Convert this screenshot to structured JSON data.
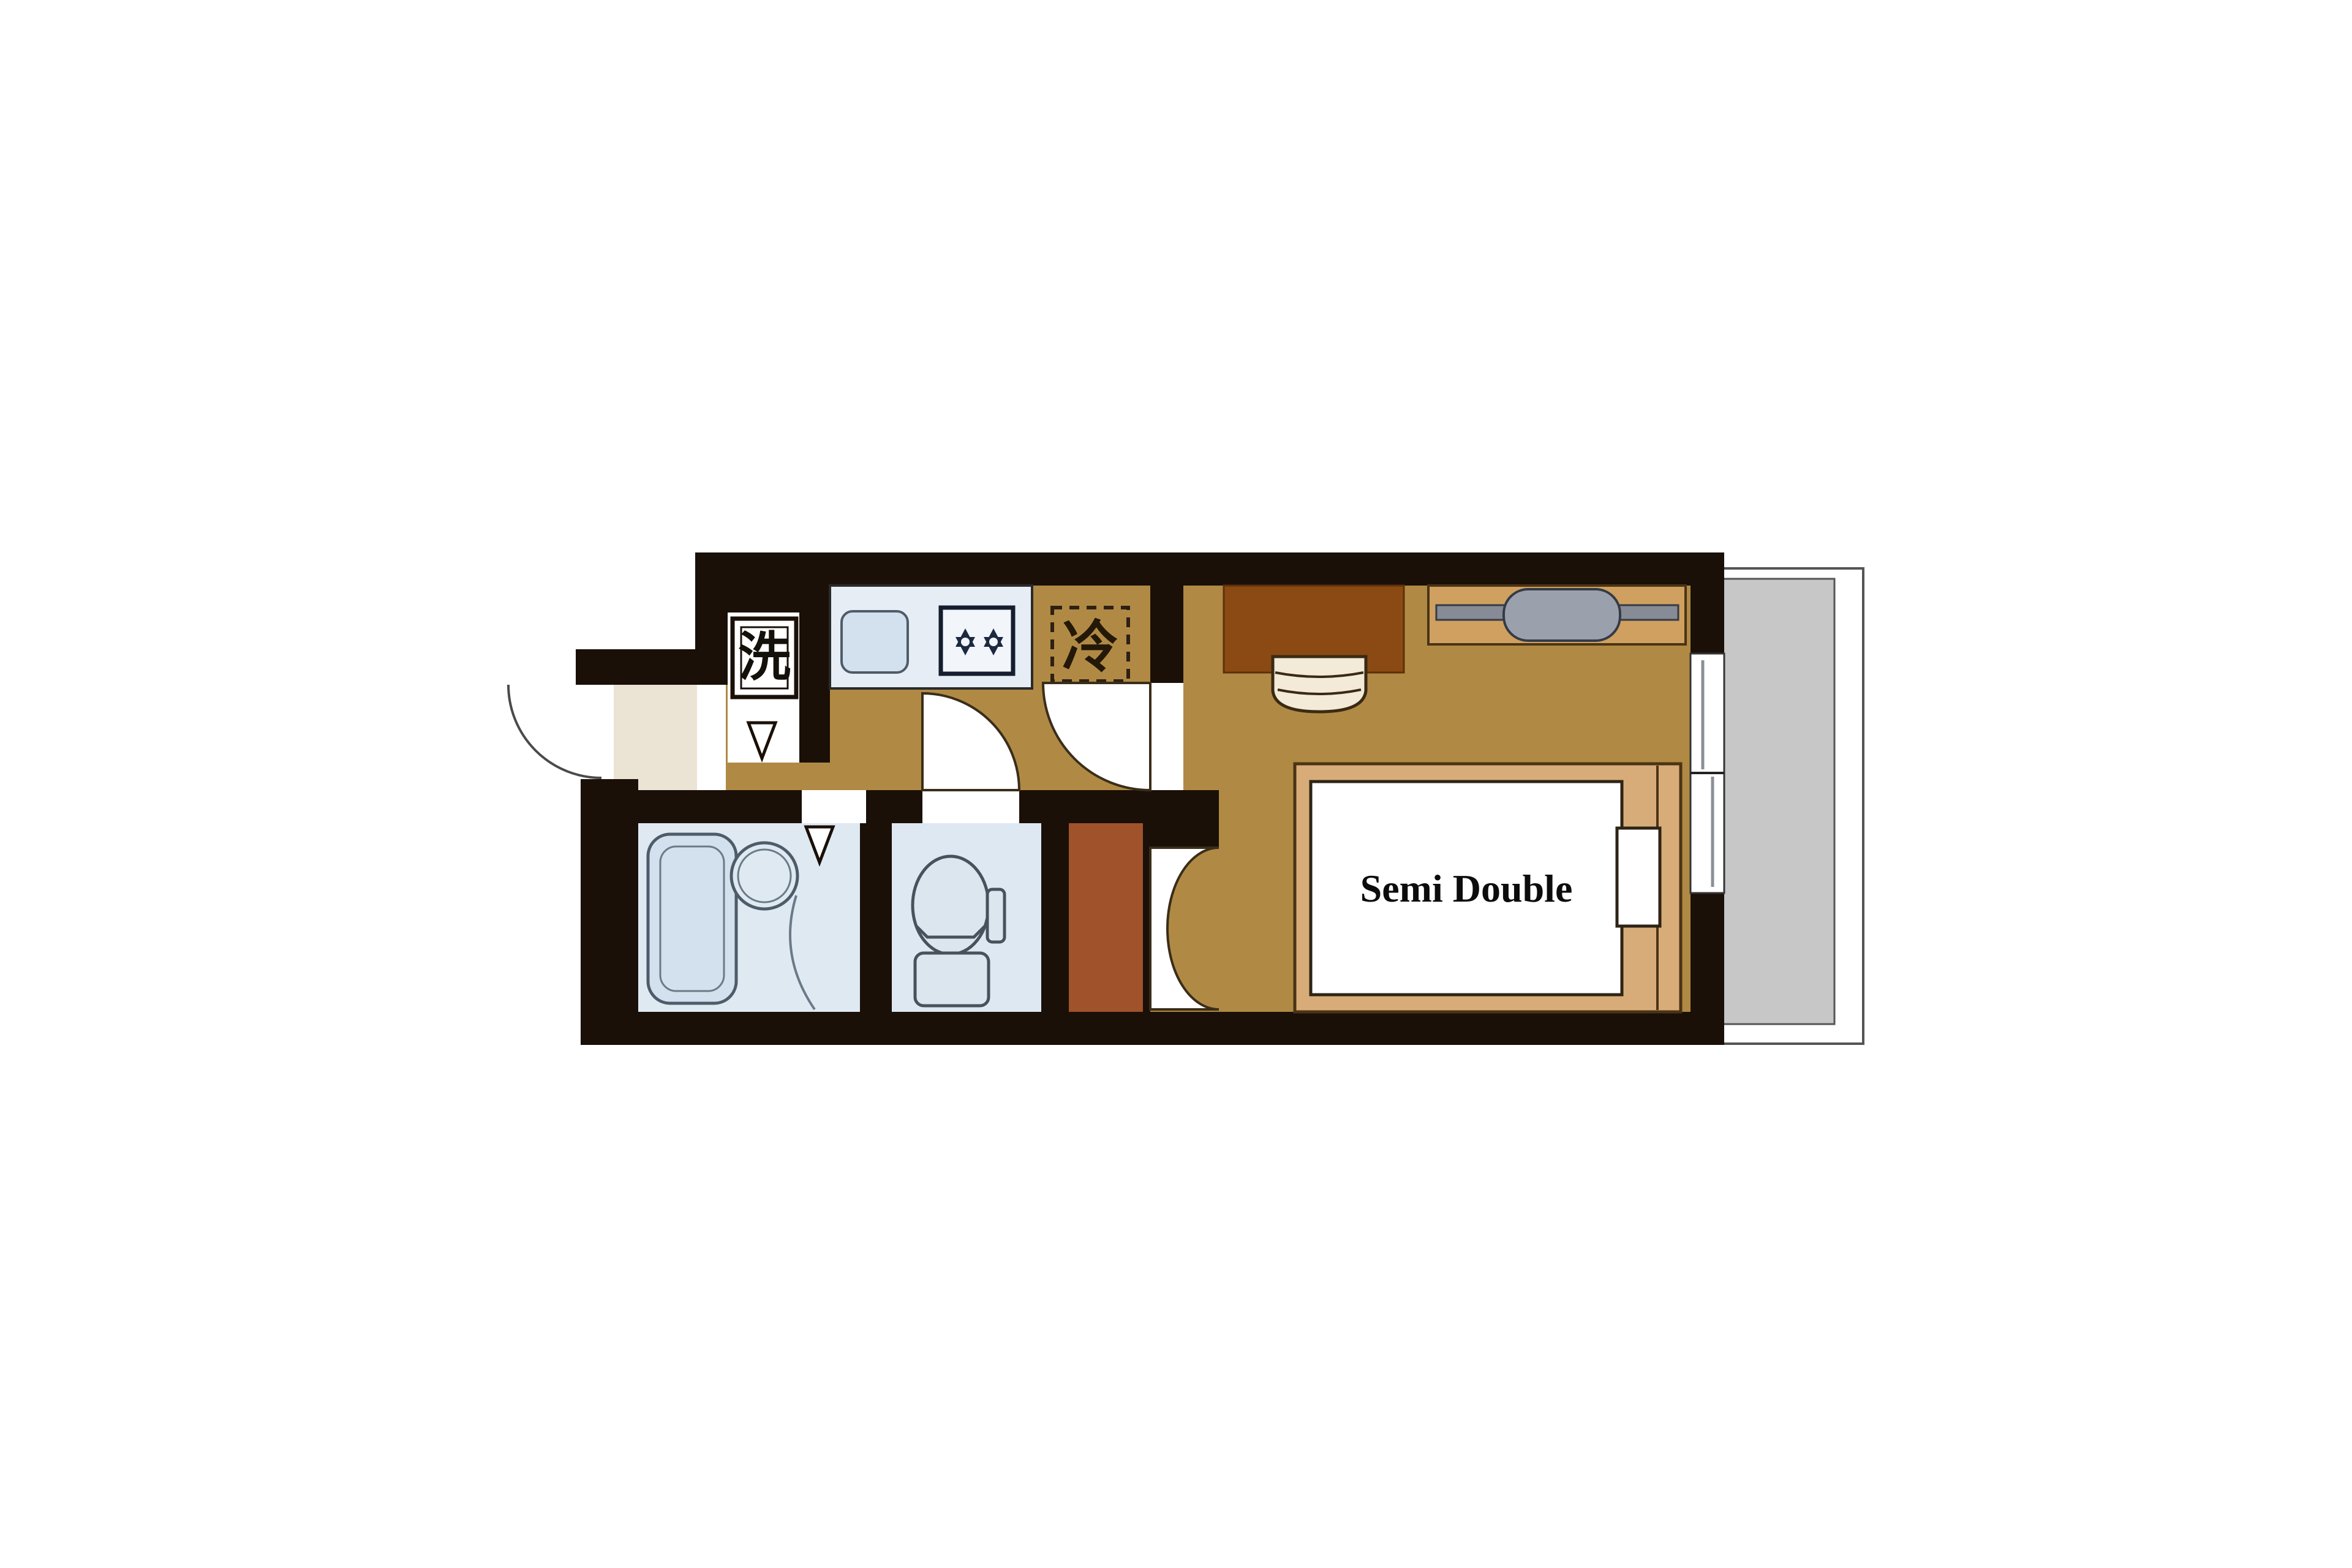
{
  "plan": {
    "labels": {
      "washer": "洗",
      "fridge": "冷",
      "bed_size": "Semi Double"
    },
    "palette": {
      "wall": "#1a1008",
      "floor_tan": "#b08a44",
      "desk_brown": "#8b4a13",
      "closet_sienna": "#a0522a",
      "bed_frame": "#d8ac79",
      "fixture_blue": "#d3e0ed",
      "fixture_border": "#4e5c6a",
      "bath_floor": "#dfe9f2",
      "counter_field": "#e7edf4",
      "balcony_gray": "#c7c7c7",
      "genkan_cream": "#ebe3d3",
      "hanger_frame": "#cfa05f",
      "hanger_rod": "#868b96",
      "hanger_oval": "#9aa1ac",
      "page_bg": "#ffffff"
    },
    "fixtures": [
      "entrance-door",
      "washing-machine-space",
      "kitchen-counter",
      "kitchen-sink",
      "two-burner-stove",
      "refrigerator-space",
      "bathtub",
      "wash-basin",
      "toilet",
      "closet",
      "folding-door",
      "toilet-door",
      "main-room-door",
      "desk",
      "chair",
      "hanger-rack",
      "semi-double-bed",
      "pillow",
      "sliding-window",
      "balcony"
    ]
  }
}
